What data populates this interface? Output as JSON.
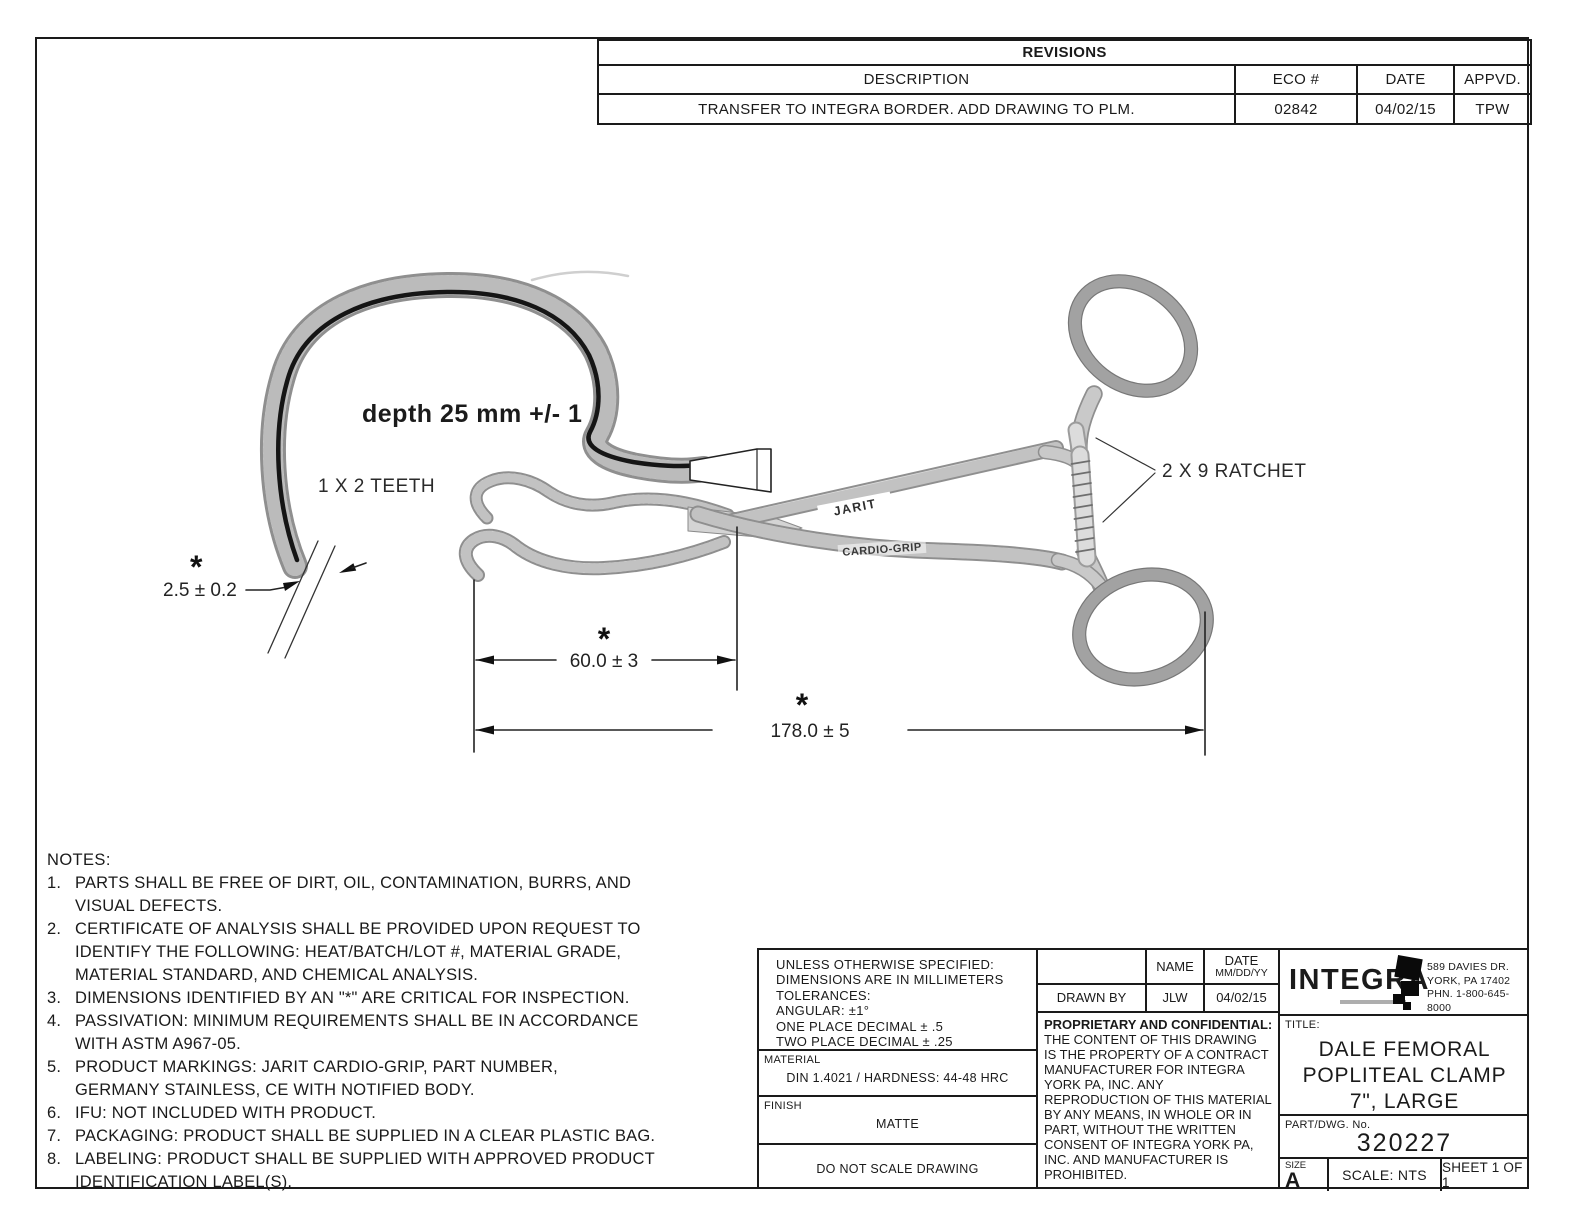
{
  "colors": {
    "ink": "#1a1a1a",
    "paper": "#ffffff",
    "steel_light": "#ececec",
    "steel_mid": "#8f8f8f"
  },
  "revisions": {
    "title": "REVISIONS",
    "columns": [
      "DESCRIPTION",
      "ECO #",
      "DATE",
      "APPVD."
    ],
    "rows": [
      {
        "description": "TRANSFER TO INTEGRA BORDER. ADD DRAWING TO PLM.",
        "eco": "02842",
        "date": "04/02/15",
        "appvd": "TPW"
      }
    ]
  },
  "drawing": {
    "depth_label": "depth 25 mm  +/- 1",
    "teeth_label": "1 X 2 TEETH",
    "ratchet_label": "2 X 9 RATCHET",
    "dim_tip": "2.5 ± 0.2",
    "dim_jaw": "60.0 ± 3",
    "dim_overall": "178.0 ± 5",
    "asterisk": "*",
    "marking_jarit": "JARIT",
    "marking_cardio": "CARDIO-GRIP"
  },
  "notes": {
    "heading": "NOTES:",
    "items": [
      {
        "num": "1.",
        "text": "PARTS SHALL BE FREE OF DIRT, OIL, CONTAMINATION, BURRS, AND\nVISUAL DEFECTS."
      },
      {
        "num": "2.",
        "text": "CERTIFICATE OF ANALYSIS SHALL BE PROVIDED UPON REQUEST TO\nIDENTIFY THE FOLLOWING: HEAT/BATCH/LOT #, MATERIAL GRADE,\nMATERIAL STANDARD, AND CHEMICAL ANALYSIS."
      },
      {
        "num": "3.",
        "text": "DIMENSIONS IDENTIFIED BY AN \"*\" ARE CRITICAL FOR INSPECTION."
      },
      {
        "num": "4.",
        "text": "PASSIVATION: MINIMUM REQUIREMENTS SHALL BE IN ACCORDANCE\nWITH ASTM A967-05."
      },
      {
        "num": "5.",
        "text": "PRODUCT MARKINGS: JARIT CARDIO-GRIP, PART NUMBER,\nGERMANY STAINLESS, CE WITH NOTIFIED BODY."
      },
      {
        "num": "6.",
        "text": "IFU: NOT INCLUDED WITH PRODUCT."
      },
      {
        "num": "7.",
        "text": "PACKAGING: PRODUCT SHALL BE SUPPLIED IN A CLEAR PLASTIC BAG."
      },
      {
        "num": "8.",
        "text": "LABELING: PRODUCT SHALL BE SUPPLIED WITH APPROVED PRODUCT\nIDENTIFICATION LABEL(S)."
      }
    ]
  },
  "title_block": {
    "tolerances": {
      "lines": [
        "UNLESS OTHERWISE SPECIFIED:",
        "DIMENSIONS ARE IN MILLIMETERS",
        "TOLERANCES:",
        "ANGULAR: ±1°",
        "ONE PLACE DECIMAL ± .5",
        "TWO PLACE DECIMAL ± .25"
      ]
    },
    "material": {
      "label": "MATERIAL",
      "value": "DIN 1.4021 / HARDNESS: 44-48 HRC"
    },
    "finish": {
      "label": "FINISH",
      "value": "MATTE"
    },
    "do_not_scale": "DO NOT SCALE DRAWING",
    "approval": {
      "name_header": "NAME",
      "date_header": "DATE",
      "date_sub": "MM/DD/YY",
      "drawn_by_label": "DRAWN BY",
      "name": "JLW",
      "date": "04/02/15"
    },
    "proprietary": {
      "heading": "PROPRIETARY AND CONFIDENTIAL:",
      "body": "THE CONTENT OF THIS DRAWING IS THE PROPERTY OF A CONTRACT MANUFACTURER FOR INTEGRA YORK PA, INC. ANY REPRODUCTION OF THIS MATERIAL BY ANY MEANS, IN WHOLE OR IN PART, WITHOUT THE WRITTEN CONSENT OF INTEGRA YORK PA, INC. AND MANUFACTURER IS PROHIBITED."
    },
    "company": {
      "name": "INTEGRA",
      "address_lines": [
        "589 DAVIES DR.",
        "YORK, PA 17402",
        "PHN. 1-800-645-8000"
      ]
    },
    "title": {
      "label": "TITLE:",
      "lines": [
        "DALE FEMORAL",
        "POPLITEAL CLAMP",
        "7\", LARGE"
      ]
    },
    "part": {
      "label": "PART/DWG. No.",
      "number": "320227"
    },
    "size": {
      "label": "SIZE",
      "value": "A"
    },
    "scale": "SCALE: NTS",
    "sheet": "SHEET 1 OF 1"
  }
}
